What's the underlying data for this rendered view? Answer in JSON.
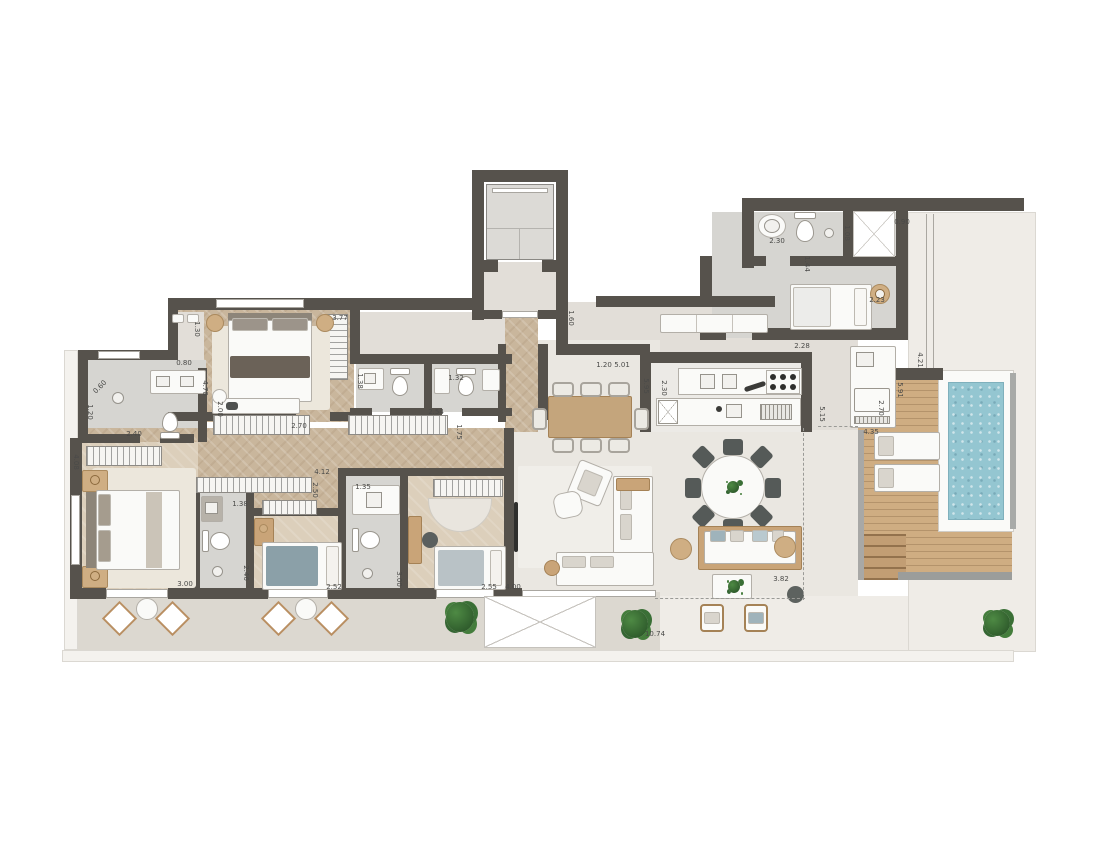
{
  "plan": {
    "colors": {
      "wall": "#56524c",
      "floor": "#e2ded8",
      "label": "#4a4a48",
      "wood_floor": "#c9b69c",
      "deck_wood": "#cfad82",
      "pool_water": "#94c6d1",
      "plant_green": "#3b6d37"
    },
    "dimension_labels": [
      {
        "t": "0.60",
        "x": 100,
        "y": 387,
        "r": -45
      },
      {
        "t": "1.20",
        "x": 90,
        "y": 412,
        "r": 90
      },
      {
        "t": "2.40",
        "x": 134,
        "y": 434,
        "r": 0
      },
      {
        "t": "0.80",
        "x": 184,
        "y": 363,
        "r": 0
      },
      {
        "t": "4.70",
        "x": 205,
        "y": 388,
        "r": 90
      },
      {
        "t": "2.00",
        "x": 220,
        "y": 409,
        "r": 90
      },
      {
        "t": "1.30",
        "x": 197,
        "y": 329,
        "r": 90
      },
      {
        "t": "3.77",
        "x": 340,
        "y": 318,
        "r": 0
      },
      {
        "t": "2.70",
        "x": 299,
        "y": 426,
        "r": 0
      },
      {
        "t": "2.54",
        "x": 436,
        "y": 412,
        "r": 0
      },
      {
        "t": "1.75",
        "x": 459,
        "y": 432,
        "r": 90
      },
      {
        "t": "1.38",
        "x": 360,
        "y": 381,
        "r": 90
      },
      {
        "t": "1.32",
        "x": 456,
        "y": 378,
        "r": 0
      },
      {
        "t": "4.08",
        "x": 76,
        "y": 462,
        "r": 90
      },
      {
        "t": "1.38",
        "x": 240,
        "y": 504,
        "r": 0
      },
      {
        "t": "2.46",
        "x": 246,
        "y": 573,
        "r": 90
      },
      {
        "t": "3.00",
        "x": 185,
        "y": 584,
        "r": 0
      },
      {
        "t": "2.52",
        "x": 334,
        "y": 587,
        "r": 0
      },
      {
        "t": "3.00",
        "x": 399,
        "y": 579,
        "r": 90
      },
      {
        "t": "2.50",
        "x": 315,
        "y": 490,
        "r": 90
      },
      {
        "t": "4.12",
        "x": 322,
        "y": 472,
        "r": 0
      },
      {
        "t": "1.35",
        "x": 363,
        "y": 487,
        "r": 0
      },
      {
        "t": "2.55",
        "x": 489,
        "y": 587,
        "r": 0
      },
      {
        "t": "4.00",
        "x": 513,
        "y": 587,
        "r": 0
      },
      {
        "t": "1.60",
        "x": 571,
        "y": 318,
        "r": 90
      },
      {
        "t": "1.20",
        "x": 604,
        "y": 365,
        "r": 0
      },
      {
        "t": "5.01",
        "x": 622,
        "y": 365,
        "r": 0
      },
      {
        "t": "5.95",
        "x": 646,
        "y": 386,
        "r": 90
      },
      {
        "t": "2.30",
        "x": 664,
        "y": 388,
        "r": 90
      },
      {
        "t": "5.15",
        "x": 822,
        "y": 414,
        "r": 90
      },
      {
        "t": "2.30",
        "x": 777,
        "y": 241,
        "r": 0
      },
      {
        "t": "1.08",
        "x": 847,
        "y": 233,
        "r": 90
      },
      {
        "t": "0.90",
        "x": 902,
        "y": 222,
        "r": 0
      },
      {
        "t": "1.44",
        "x": 807,
        "y": 264,
        "r": 90
      },
      {
        "t": "2.23",
        "x": 877,
        "y": 300,
        "r": 0
      },
      {
        "t": "2.28",
        "x": 802,
        "y": 346,
        "r": 0
      },
      {
        "t": "4.21",
        "x": 920,
        "y": 360,
        "r": 90
      },
      {
        "t": "5.91",
        "x": 900,
        "y": 390,
        "r": 90
      },
      {
        "t": "2.70",
        "x": 881,
        "y": 408,
        "r": 90
      },
      {
        "t": "4.35",
        "x": 871,
        "y": 432,
        "r": 0
      },
      {
        "t": "3.82",
        "x": 781,
        "y": 579,
        "r": 0
      },
      {
        "t": "10.74",
        "x": 655,
        "y": 634,
        "r": 0
      }
    ]
  }
}
